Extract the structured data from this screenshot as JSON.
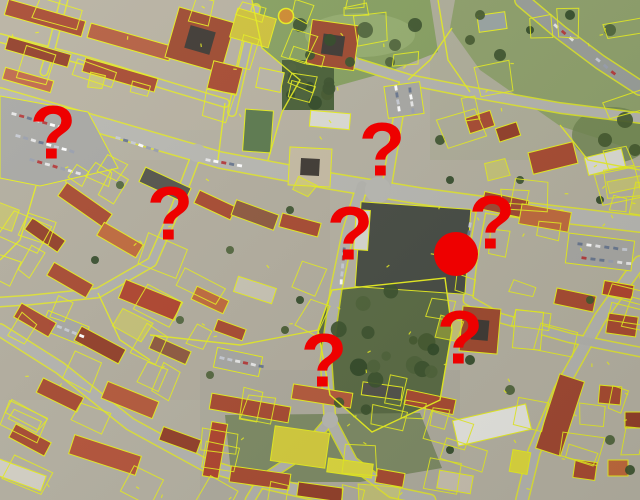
{
  "colors": {
    "marker_red": "#ee0000",
    "cadastral_yellow": "#e7ee20"
  },
  "markers": {
    "question_marks": [
      {
        "symbol": "?",
        "x": 53,
        "y": 136
      },
      {
        "symbol": "?",
        "x": 170,
        "y": 217
      },
      {
        "symbol": "?",
        "x": 382,
        "y": 153
      },
      {
        "symbol": "?",
        "x": 350,
        "y": 237
      },
      {
        "symbol": "?",
        "x": 492,
        "y": 226
      },
      {
        "symbol": "?",
        "x": 460,
        "y": 341
      },
      {
        "symbol": "?",
        "x": 324,
        "y": 364
      }
    ],
    "selected_circle": {
      "x": 456,
      "y": 254,
      "radius": 22
    }
  }
}
